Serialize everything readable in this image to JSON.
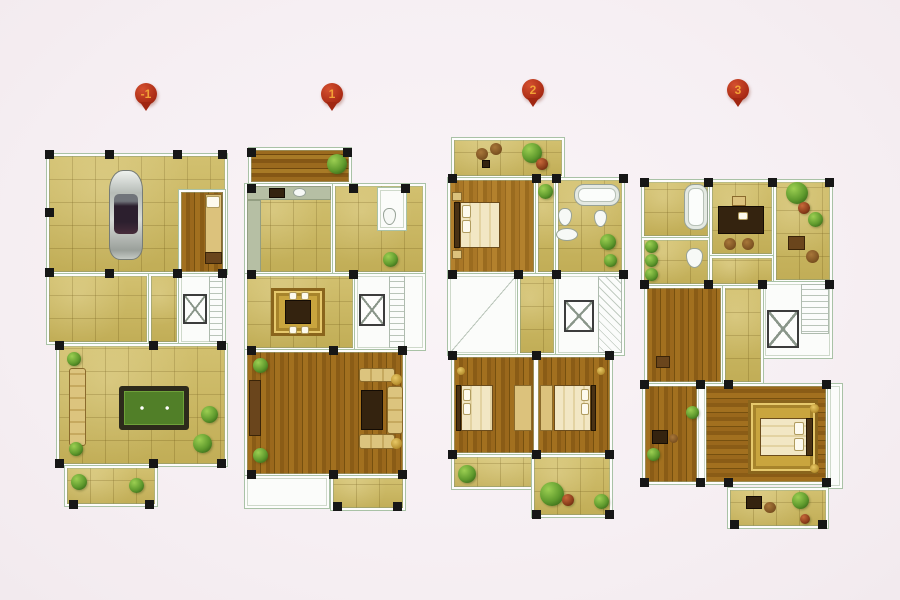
{
  "document": {
    "kind": "residential-floor-plan-sheet",
    "floors": [
      {
        "marker_label": "-1",
        "name": "basement",
        "features": [
          "garage-car",
          "storage-room-bed",
          "stairwell-elevator",
          "billiard-table",
          "sofa",
          "patio-plants"
        ]
      },
      {
        "marker_label": "1",
        "name": "first-floor",
        "features": [
          "wood-deck",
          "kitchen-counters",
          "bathroom-toilet",
          "dining-table-rug",
          "stairwell-elevator",
          "living-room-sofa-set",
          "entry-porch"
        ]
      },
      {
        "marker_label": "2",
        "name": "second-floor",
        "features": [
          "terrace-seating",
          "bedroom-bed",
          "bathroom-tub-toilets",
          "stairwell-elevator",
          "two-bedrooms-beds",
          "balcony-plants"
        ]
      },
      {
        "marker_label": "3",
        "name": "third-floor",
        "features": [
          "bathroom-tub",
          "study-desk-chairs",
          "terrace-plants",
          "powder-room-toilet",
          "dressing-room",
          "stairwell-elevator",
          "master-bedroom-bed-rug",
          "balcony-table-plants"
        ]
      }
    ],
    "colors": {
      "background": "#f6eff3",
      "marker_red": "#a92a14",
      "marker_number": "#f2a236",
      "tile_floor": "#cdb95f",
      "wood_floor": "#96671c",
      "pool_table_felt": "#517f28",
      "kitchen_counter": "#b6bfa4",
      "wall_outline": "#a9c2a6",
      "column_black": "#161616",
      "plant_green": "#5f9a2d",
      "plant_red": "#8a3d1a",
      "rug_gold": "#c9a53e"
    }
  }
}
